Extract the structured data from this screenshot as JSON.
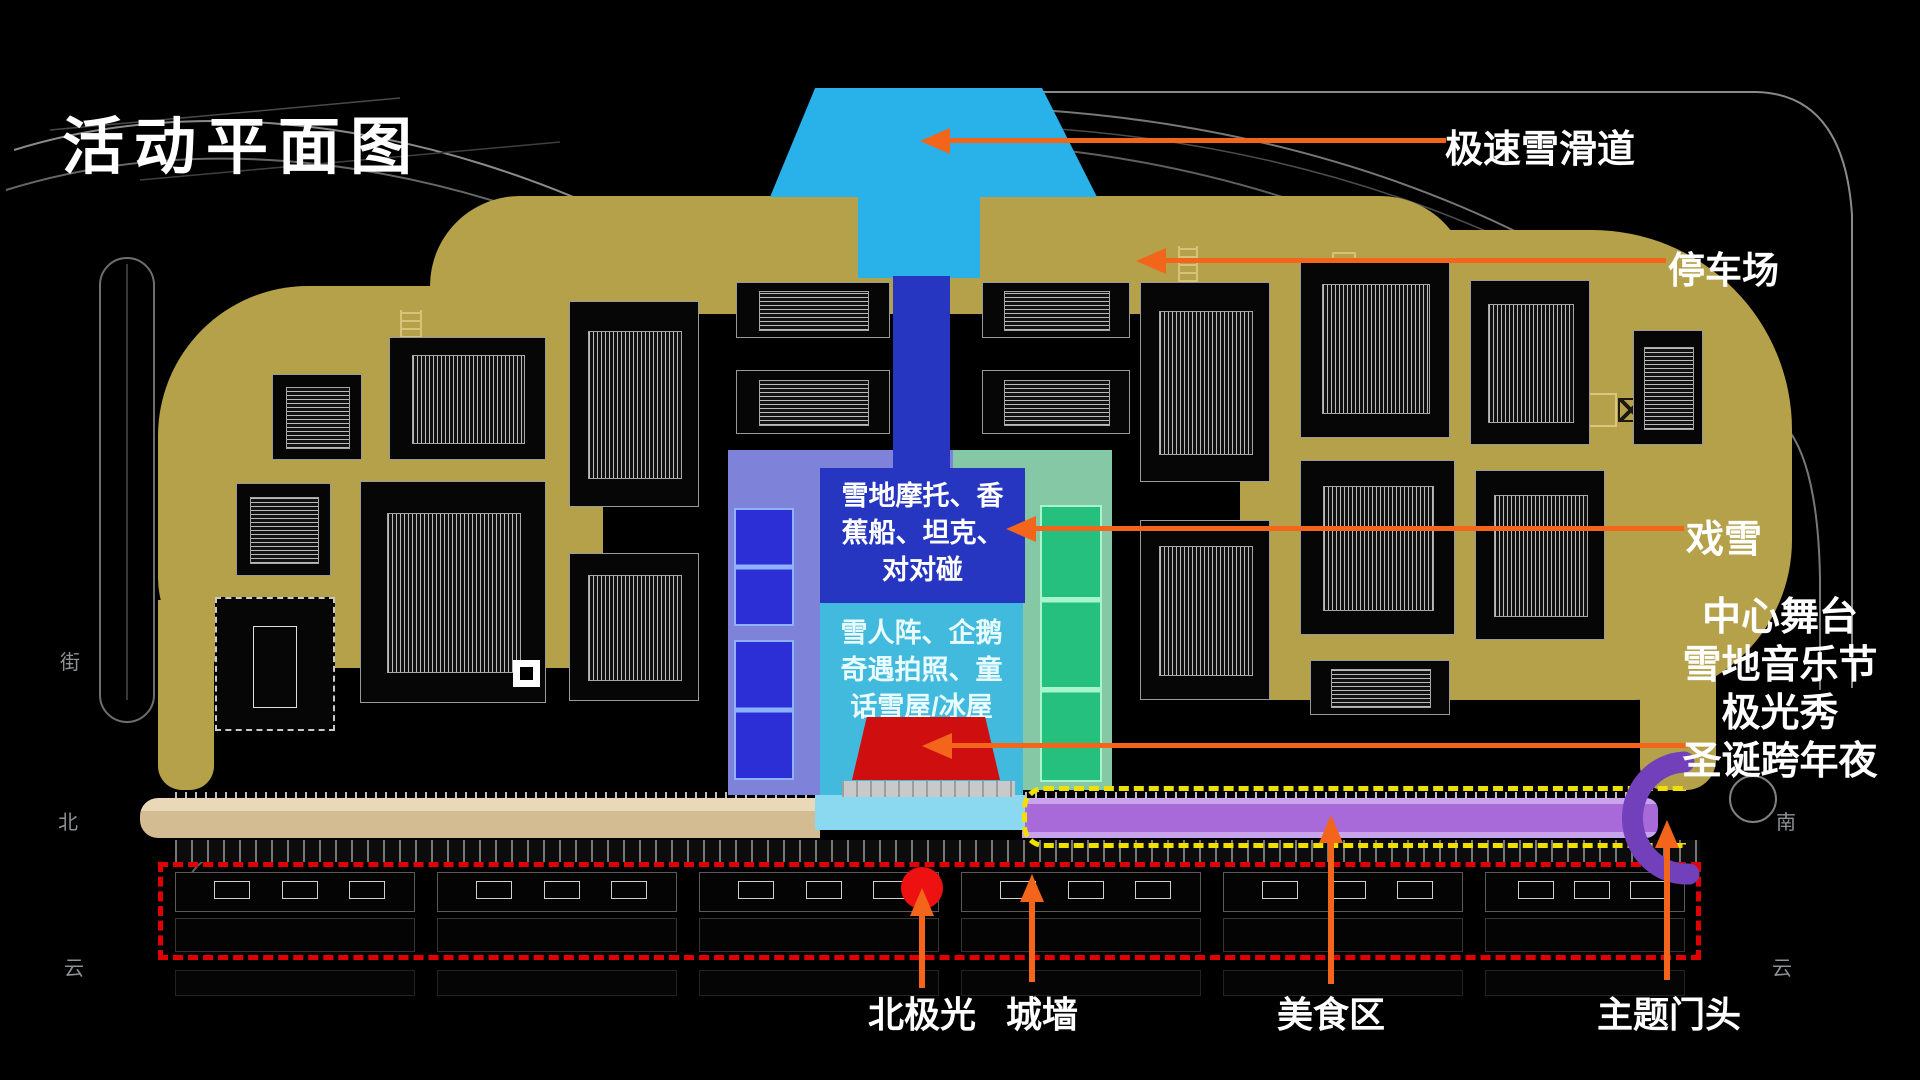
{
  "title": "活动平面图",
  "callouts": {
    "slide": {
      "label": "极速雪滑道"
    },
    "parking": {
      "label": "停车场"
    },
    "snow_play": {
      "label": "戏雪"
    },
    "stage_block": {
      "lines": [
        "中心舞台",
        "雪地音乐节",
        "极光秀",
        "圣诞跨年夜"
      ]
    },
    "aurora": {
      "label": "北极光"
    },
    "wall": {
      "label": "城墙"
    },
    "food": {
      "label": "美食区"
    },
    "gate": {
      "label": "主题门头"
    }
  },
  "zones": {
    "rides": {
      "lines": [
        "雪地摩托、香",
        "蕉船、坦克、",
        "对对碰"
      ]
    },
    "photo": {
      "lines": [
        "雪人阵、企鹅",
        "奇遇拍照、童",
        "话雪屋/冰屋"
      ]
    }
  },
  "map_texts": {
    "street_left": "街",
    "north": "北",
    "cloud_left": "云",
    "south": "南",
    "cloud_right": "云"
  },
  "colors": {
    "orange": "#f4651c",
    "reddash": "#e00000",
    "yellow": "#f0e000",
    "sky": "#29b1ea",
    "royal": "#2636c0",
    "cyanbox": "#41bade",
    "lightcyan": "#8bd9f0",
    "periwinkle": "#7e82d8",
    "innerblue": "#2d2fd6",
    "greenlight": "#84c8a6",
    "greenbright": "#25c07d",
    "purplestrip": "#a76ad8",
    "purplelight": "#c9a4ec",
    "gatepurple": "#7340bc",
    "stagered": "#cf0f0f",
    "dotred": "#ee1111",
    "tan": "#b5a14a",
    "roadtan": "#d8c29c"
  }
}
